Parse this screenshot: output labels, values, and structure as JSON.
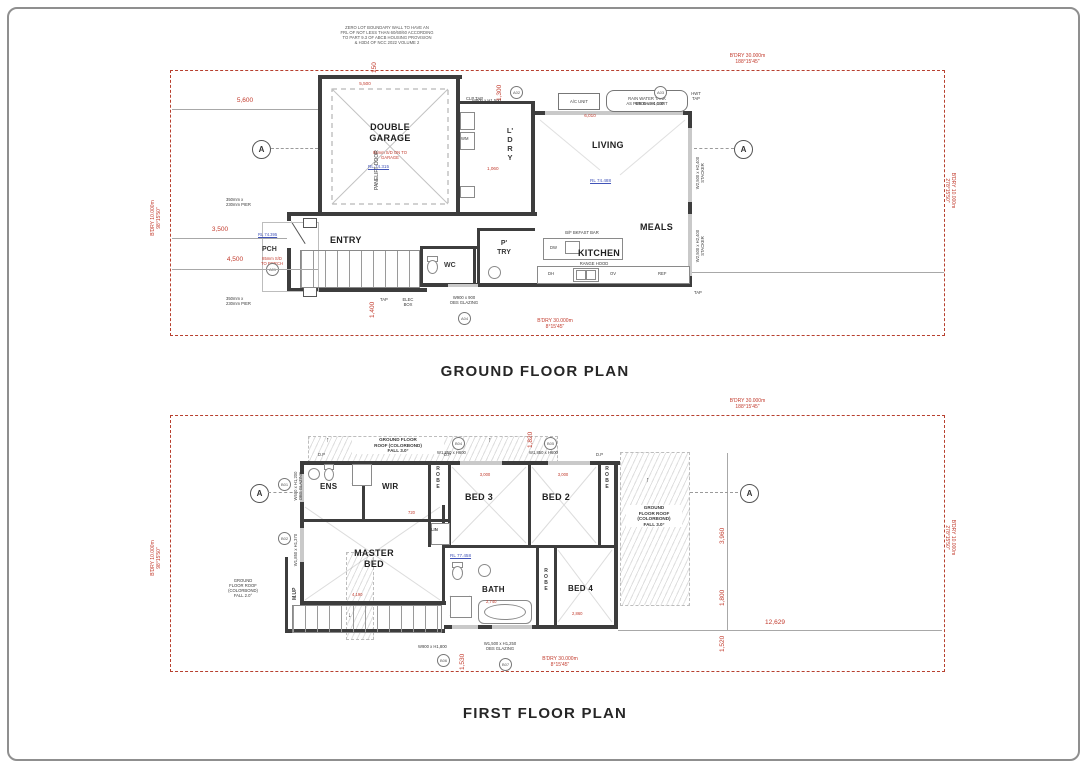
{
  "palette": {
    "boundary_red": "#b7402f",
    "dim_red": "#c23b2d",
    "rl_blue": "#4053b8",
    "wall": "#3d3d3d"
  },
  "titles": {
    "ground": "GROUND FLOOR PLAN",
    "first": "FIRST FLOOR PLAN"
  },
  "note_zero_lot": "ZERO LOT BOUNDARY WALL TO HAVE AN\nFRL OF NOT LESS THAN 60/60/60 ACCORDING\nTO PART 9.3 OF ABCB HOUSING PROVISION\n& H3D4 OF NCC 2022 VOLUME 2",
  "glyphs": {
    "up_arrow": "↑",
    "down_arrow": "↓"
  },
  "section_marker": "A",
  "boundary": {
    "top": "B'DRY 30.000m\n188°15'45\"",
    "top_ff": "B'DRY 30.000m\n188°15'45\"",
    "bottom_gf": "B'DRY 30.000m\n8°15'45\"",
    "bottom_ff": "B'DRY 30.000m\n8°15'45\"",
    "left": "B'DRY 10.000m\n98°15'50\"",
    "left_ff": "B'DRY 10.000m\n98°15'50\"",
    "right": "B'DRY 10.000m\n278°15'50\"",
    "right_ff": "B'DRY 10.000m\n278°15'50\""
  },
  "gf": {
    "rooms": {
      "garage": "DOUBLE\nGARAGE",
      "garage_note": "85mm S/D ON TO\nGARAGE",
      "garage_rl": "RL 74.315",
      "panelift": "PANELIFT DOOR",
      "ldry": "L'\nD\nR\nY",
      "entry": "ENTRY",
      "pch": "PCH",
      "pch_note": "85mm S/D\nTO PORCH",
      "pch_rl": "RL 74.395",
      "wc": "WC",
      "ptry": "P'\nTRY",
      "kitchen": "KITCHEN",
      "meals": "MEALS",
      "living": "LIVING",
      "living_rl": "RL 74.488"
    },
    "kitchen": {
      "range_hood": "RANGE HOOD",
      "bkfast_bar": "B/F BKFAST BAR",
      "dw": "DW",
      "ov": "OV",
      "dh": "DH",
      "ref": "REF"
    },
    "equipment": {
      "ac_unit": "A/C UNIT",
      "rain_tank": "RAIN WATER TANK\nAS PER BASIX CERT",
      "hwt_tap": "HWT\nTAP",
      "clp_tap": "CLP TAP",
      "tap": "TAP",
      "elec_box": "ELEC\nBOX",
      "wm": "WM",
      "pier1": "350mm x\n230mm PIER",
      "pier2": "350mm x\n230mm PIER"
    },
    "windows": {
      "a01": "A01",
      "a02": "A02",
      "a03": "A03",
      "a04": "A04",
      "top_left": "W600 x H1,500",
      "top_right": "W600 x H1,500",
      "obs": "W900 x 900\nOBS GLAZING",
      "stacker1": "W2,500 x H2,400\nSTACKER",
      "stacker2": "W2,500 x H2,400\nSTACKER"
    },
    "dims": {
      "d150": "150",
      "d5500": "5,500",
      "d5600": "5,600",
      "d3500": "3,500",
      "d4500": "4,500",
      "d1300": "1,300",
      "d1400": "1,400",
      "d6010": "6,010",
      "d1060": "1,060"
    }
  },
  "ff": {
    "rooms": {
      "ens": "ENS",
      "wir": "WIR",
      "robe1": "R\nO\nB\nE",
      "robe2": "R\nO\nB\nE",
      "robe3": "R\nO\nB\nE",
      "bed3": "BED 3",
      "bed2": "BED 2",
      "bed4": "BED 4",
      "master": "MASTER\nBED",
      "lin": "LIN",
      "bath": "BATH",
      "mup": "M.UP",
      "rl": "RL 77.458"
    },
    "roof": {
      "top": "GROUND FLOOR\nROOF (COLORBOND)\nFALL 3.0°",
      "right": "GROUND\nFLOOR ROOF\n(COLORBOND)\nFALL 3.0°",
      "left": "GROUND\nFLOOR ROOF\n(COLORBOND)\nFALL 2.0°"
    },
    "labels": {
      "dp": "D.P"
    },
    "windows": {
      "b01": "B01",
      "b02": "B02",
      "b04": "B04",
      "b05": "B05",
      "b06": "B06",
      "b07": "B07",
      "top1": "W1,850 x H600",
      "top2": "W1,850 x H600",
      "left1": "W600 x H1,200\nOBS GLAZING",
      "left2": "W1,850 x H1,370",
      "bottom1": "W900 x H1,800",
      "bottom2": "W1,500 x H1,250\nOBS GLAZING"
    },
    "dims": {
      "d1820": "1,820",
      "d1530": "1,530",
      "d12629": "12,629",
      "d3960": "3,960",
      "d1800": "1,800",
      "d1520": "1,520",
      "d3000a": "3,000",
      "d3000b": "3,000",
      "d4190": "4,190",
      "d2740": "2,740",
      "d2860": "2,860",
      "d720": "720"
    }
  }
}
